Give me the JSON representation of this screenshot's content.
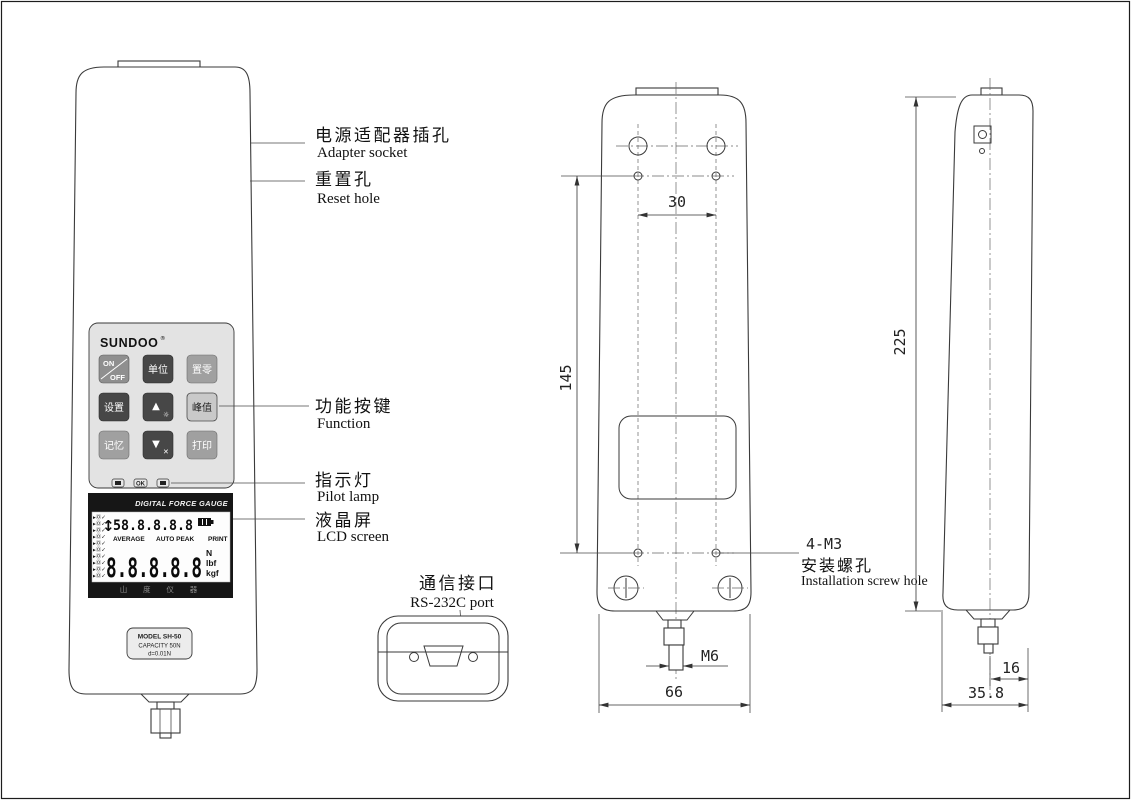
{
  "front": {
    "logo": "SUNDOO",
    "logo_mark": "®",
    "keypad": {
      "btn_on_line1": "ON",
      "btn_on_line2": "OFF",
      "btn_unit": "单位",
      "btn_zero": "置零",
      "btn_set": "设置",
      "btn_up": "▲",
      "btn_up_sub": "☼",
      "btn_peak": "峰值",
      "btn_mem": "记忆",
      "btn_down": "▼",
      "btn_down_sub": "✕",
      "btn_print": "打印"
    },
    "pilot": {
      "ok": "OK"
    },
    "lcd": {
      "header": "DIGITAL FORCE GAUGE",
      "updown": "↕",
      "top_reading": "58.8.8.8.8",
      "status_icon": "▸Ⓞ✓",
      "mode1": "AVERAGE",
      "mode2": "AUTO PEAK",
      "mode3": "PRINT",
      "main_reading": "8.8.8.8.8",
      "unit1": "N",
      "unit2": "lbf",
      "unit3": "kgf",
      "footer": "山 度 仪 器"
    },
    "model": {
      "line1": "MODEL SH-50",
      "line2": "CAPACITY 50N",
      "line3": "d=0.01N"
    }
  },
  "callouts": {
    "adapter_zh": "电源适配器插孔",
    "adapter_en": "Adapter socket",
    "reset_zh": "重置孔",
    "reset_en": "Reset hole",
    "function_zh": "功能按键",
    "function_en": "Function",
    "pilot_zh": "指示灯",
    "pilot_en": "Pilot lamp",
    "lcd_zh": "液晶屏",
    "lcd_en": "LCD screen",
    "comm_zh": "通信接口",
    "comm_en": "RS-232C  port",
    "screw_code": "4-M3",
    "screw_zh": "安装螺孔",
    "screw_en": "Installation screw hole"
  },
  "dims": {
    "hole_spacing": "30",
    "hole_vspan": "145",
    "height": "225",
    "width": "66",
    "thread": "M6",
    "tip_offset": "16",
    "depth": "35.8"
  }
}
